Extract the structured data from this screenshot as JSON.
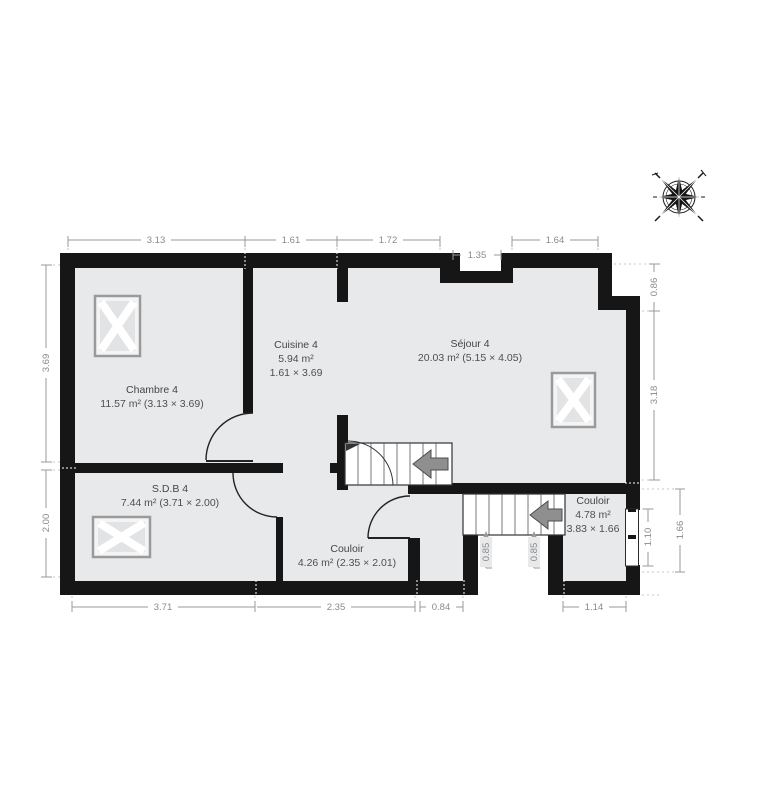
{
  "plan": {
    "type": "floor-plan",
    "rooms": [
      {
        "name": "Chambre 4",
        "area": "11.57 m² (3.13 × 3.69)"
      },
      {
        "name": "Cuisine 4",
        "area": "5.94 m²",
        "size": "1.61 × 3.69"
      },
      {
        "name": "Séjour 4",
        "area": "20.03 m² (5.15 × 4.05)"
      },
      {
        "name": "S.D.B 4",
        "area": "7.44 m² (3.71 × 2.00)"
      },
      {
        "name": "Couloir",
        "area": "4.26 m² (2.35 × 2.01)"
      },
      {
        "name": "Couloir",
        "area": "4.78 m²",
        "size": "3.83 × 1.66"
      }
    ],
    "dimensions": {
      "top": [
        "3.13",
        "1.61",
        "1.72",
        "1.35",
        "1.64"
      ],
      "left": [
        "3.69",
        "2.00"
      ],
      "right": [
        "0.86",
        "3.18",
        "1.10",
        "1.66"
      ],
      "bottom": [
        "3.71",
        "2.35",
        "0.84",
        "1.14"
      ],
      "inner": [
        "0.85",
        "0.85"
      ]
    },
    "icons": {
      "compass": "compass-rose"
    },
    "colors": {
      "wall": "#161616",
      "floor": "#e8e9eb",
      "dimension_text": "#8a8a8a",
      "room_text": "#4a4a4a",
      "stairs_arrow": "#8f8f8f"
    }
  }
}
